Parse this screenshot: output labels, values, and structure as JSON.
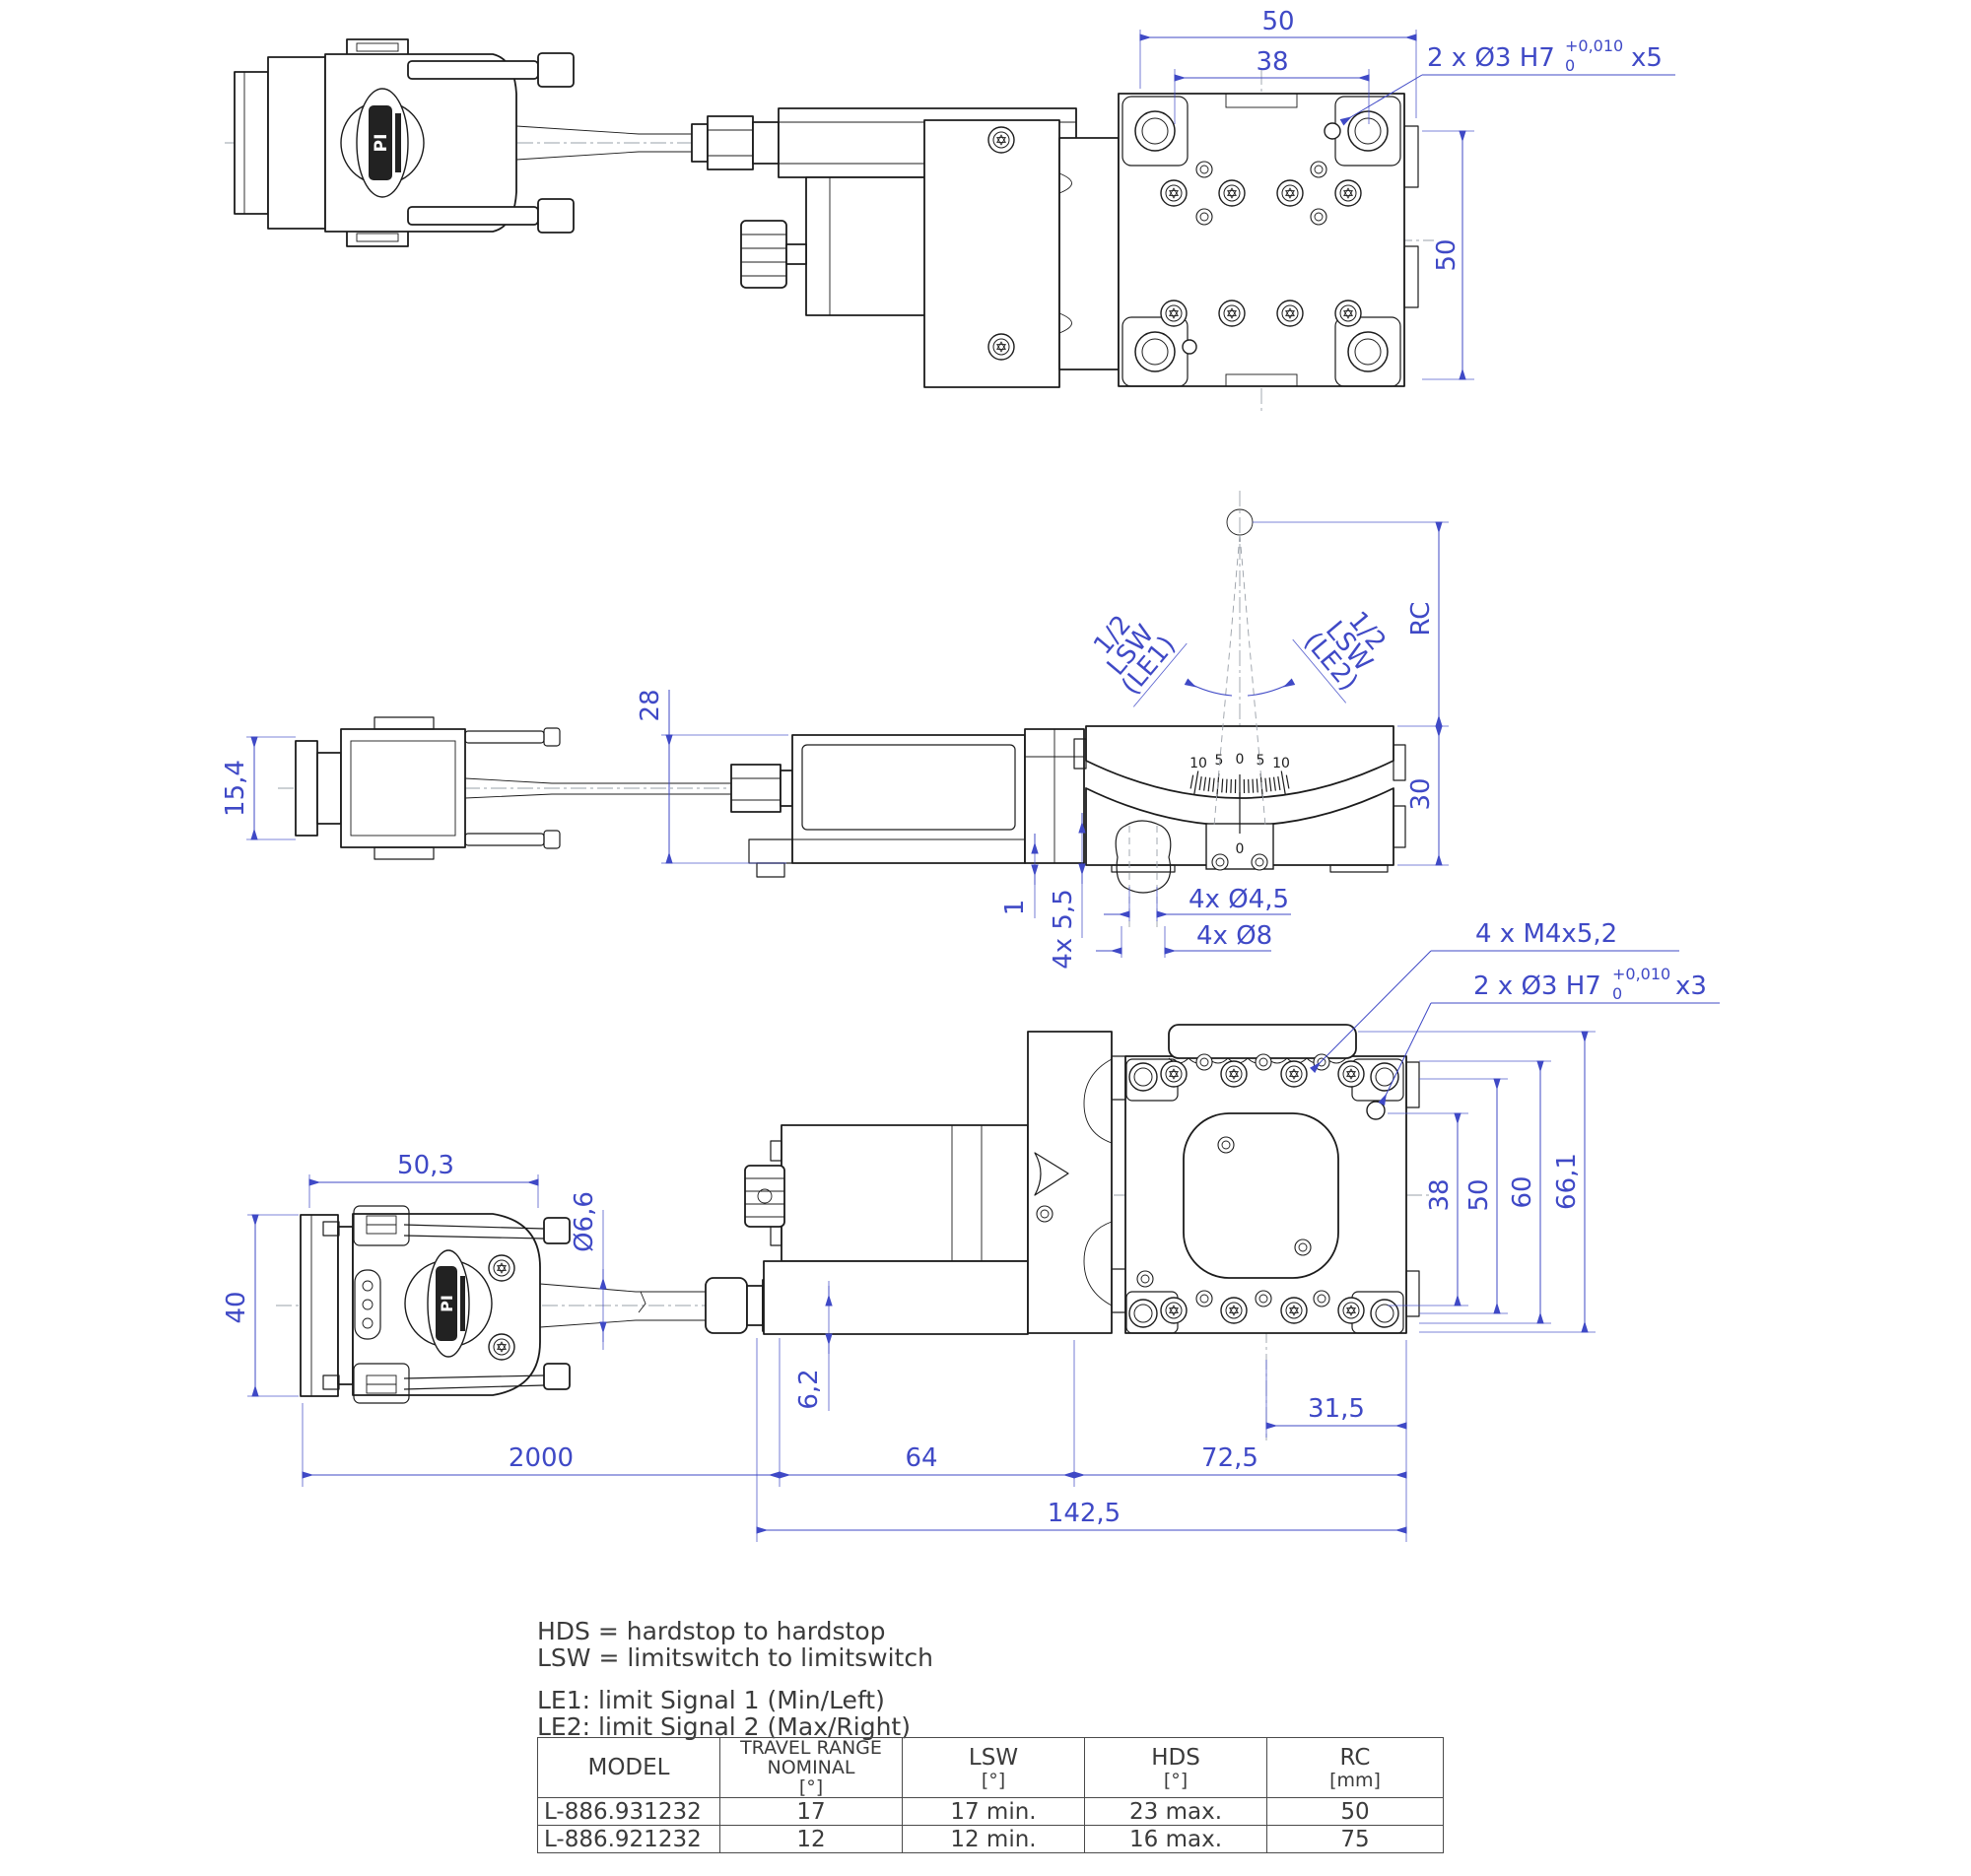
{
  "colors": {
    "line": "#1c1c1c",
    "dimension": "#3f49c6",
    "centerline": "#9aa0a8",
    "text": "#3b3b3b"
  },
  "logo": {
    "brand": "PI"
  },
  "top_view": {
    "dim_width_outer": "50",
    "dim_width_holes": "38",
    "dim_height": "50",
    "leader_dowel": {
      "main": "2 x Ø3 H7",
      "tol_upper": "+0,010",
      "tol_lower": "0",
      "depth": "x5"
    }
  },
  "side_view": {
    "dim_connector_height": "15,4",
    "dim_motor_height": "28",
    "dim_rc": "RC",
    "dim_stage_height": "30",
    "dim_offset": "1",
    "dim_slot": "4x 5,5",
    "dim_hole_small": "4x Ø4,5",
    "dim_hole_large": "4x Ø8",
    "scale_labels": [
      "10",
      "5",
      "0",
      "5",
      "10"
    ],
    "pointer_label": "0",
    "lsw_left": [
      "1/2",
      "LSW",
      "(LE1)"
    ],
    "lsw_right": [
      "1/2",
      "LSW",
      "(LE2)"
    ]
  },
  "front_view": {
    "dim_connector_width": "50,3",
    "dim_connector_height": "40",
    "dim_cable": "Ø6,6",
    "dim_cable_offset": "6,2",
    "dim_cable_length": "2000",
    "dim_motor_length": "64",
    "dim_stage_length": "72,5",
    "dim_total_length": "142,5",
    "dim_platform_offset": "31,5",
    "dim_h38": "38",
    "dim_h50": "50",
    "dim_h60": "60",
    "dim_h661": "66,1",
    "leader_m4": "4 x M4x5,2",
    "leader_dowel": {
      "main": "2 x Ø3 H7",
      "tol_upper": "+0,010",
      "tol_lower": "0",
      "depth": "x3"
    }
  },
  "notes": {
    "hds": "HDS = hardstop to hardstop",
    "lsw": "LSW = limitswitch to limitswitch",
    "le1": "LE1: limit Signal 1 (Min/Left)",
    "le2": "LE2: limit Signal 2 (Max/Right)"
  },
  "table": {
    "headers": {
      "model": "MODEL",
      "travel1": "TRAVEL RANGE",
      "travel2": "NOMINAL",
      "travel3": "[°]",
      "lsw1": "LSW",
      "lsw2": "[°]",
      "hds1": "HDS",
      "hds2": "[°]",
      "rc1": "RC",
      "rc2": "[mm]"
    },
    "rows": [
      {
        "model": "L-886.931232",
        "travel": "17",
        "lsw": "17 min.",
        "hds": "23 max.",
        "rc": "50"
      },
      {
        "model": "L-886.921232",
        "travel": "12",
        "lsw": "12 min.",
        "hds": "16 max.",
        "rc": "75"
      }
    ]
  }
}
